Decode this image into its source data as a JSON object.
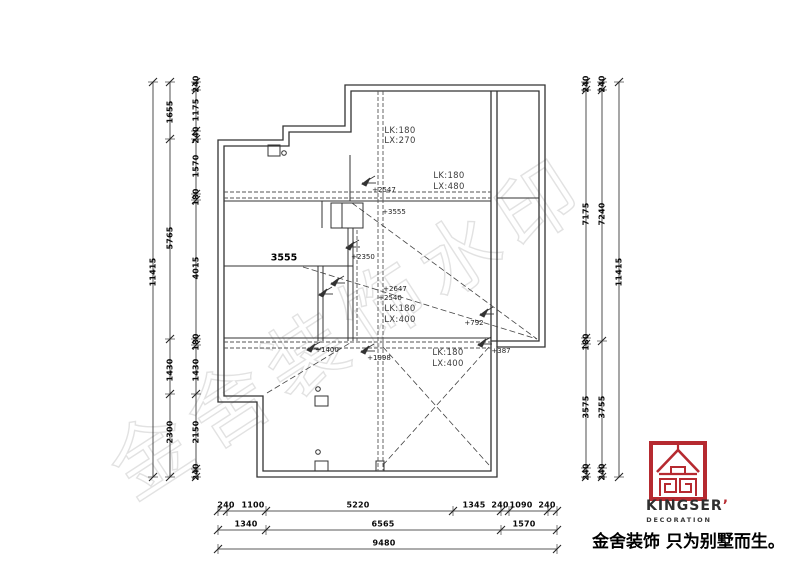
{
  "colors": {
    "accent_red": "#b62a30",
    "line": "#333333",
    "watermark_gray": "#e0e0e0"
  },
  "watermark": "金舍装饰水印",
  "logo": {
    "brand": "KINGSER",
    "mark": "’",
    "subtitle": "DECORATION",
    "tagline": "金舍装饰 只为别墅而生。"
  },
  "labels": [
    {
      "t": "240",
      "x": 196,
      "y": 84,
      "r": -90,
      "c": "dim"
    },
    {
      "t": "1175",
      "x": 196,
      "y": 110,
      "r": -90,
      "c": "dim"
    },
    {
      "t": "240",
      "x": 196,
      "y": 135,
      "r": -90,
      "c": "dim"
    },
    {
      "t": "1570",
      "x": 196,
      "y": 166,
      "r": -90,
      "c": "dim"
    },
    {
      "t": "180",
      "x": 196,
      "y": 197,
      "r": -90,
      "c": "dim"
    },
    {
      "t": "4015",
      "x": 196,
      "y": 268,
      "r": -90,
      "c": "dim"
    },
    {
      "t": "180",
      "x": 196,
      "y": 342,
      "r": -90,
      "c": "dim"
    },
    {
      "t": "1430",
      "x": 196,
      "y": 370,
      "r": -90,
      "c": "dim"
    },
    {
      "t": "2150",
      "x": 196,
      "y": 432,
      "r": -90,
      "c": "dim"
    },
    {
      "t": "240",
      "x": 196,
      "y": 472,
      "r": -90,
      "c": "dim"
    },
    {
      "t": "1655",
      "x": 170,
      "y": 112,
      "r": -90,
      "c": "dim"
    },
    {
      "t": "5765",
      "x": 170,
      "y": 238,
      "r": -90,
      "c": "dim"
    },
    {
      "t": "1430",
      "x": 170,
      "y": 370,
      "r": -90,
      "c": "dim"
    },
    {
      "t": "2300",
      "x": 170,
      "y": 432,
      "r": -90,
      "c": "dim"
    },
    {
      "t": "11415",
      "x": 153,
      "y": 272,
      "r": -90,
      "c": "dim"
    },
    {
      "t": "240",
      "x": 586,
      "y": 84,
      "r": -90,
      "c": "dim"
    },
    {
      "t": "7175",
      "x": 586,
      "y": 214,
      "r": -90,
      "c": "dim"
    },
    {
      "t": "180",
      "x": 586,
      "y": 342,
      "r": -90,
      "c": "dim"
    },
    {
      "t": "3575",
      "x": 586,
      "y": 407,
      "r": -90,
      "c": "dim"
    },
    {
      "t": "240",
      "x": 586,
      "y": 472,
      "r": -90,
      "c": "dim"
    },
    {
      "t": "240",
      "x": 602,
      "y": 84,
      "r": -90,
      "c": "dim"
    },
    {
      "t": "7240",
      "x": 602,
      "y": 214,
      "r": -90,
      "c": "dim"
    },
    {
      "t": "3755",
      "x": 602,
      "y": 407,
      "r": -90,
      "c": "dim"
    },
    {
      "t": "240",
      "x": 602,
      "y": 472,
      "r": -90,
      "c": "dim"
    },
    {
      "t": "11415",
      "x": 619,
      "y": 272,
      "r": -90,
      "c": "dim"
    },
    {
      "t": "240",
      "x": 226,
      "y": 505,
      "c": "dim"
    },
    {
      "t": "1100",
      "x": 253,
      "y": 505,
      "c": "dim"
    },
    {
      "t": "5220",
      "x": 358,
      "y": 505,
      "c": "dim"
    },
    {
      "t": "1345",
      "x": 474,
      "y": 505,
      "c": "dim"
    },
    {
      "t": "240",
      "x": 500,
      "y": 505,
      "c": "dim"
    },
    {
      "t": "1090",
      "x": 521,
      "y": 505,
      "c": "dim"
    },
    {
      "t": "240",
      "x": 547,
      "y": 505,
      "c": "dim"
    },
    {
      "t": "1340",
      "x": 246,
      "y": 524,
      "c": "dim"
    },
    {
      "t": "6565",
      "x": 383,
      "y": 524,
      "c": "dim"
    },
    {
      "t": "1570",
      "x": 524,
      "y": 524,
      "c": "dim"
    },
    {
      "t": "9480",
      "x": 384,
      "y": 543,
      "c": "dim"
    },
    {
      "n": "room-dim-label",
      "t": "3555",
      "x": 284,
      "y": 258,
      "c": "dimb"
    },
    {
      "n": "level-label",
      "t": "+2547",
      "x": 384,
      "y": 190,
      "c": "lvl"
    },
    {
      "n": "level-label",
      "t": "+3555",
      "x": 394,
      "y": 212,
      "c": "lvl"
    },
    {
      "n": "level-label",
      "t": "+2350",
      "x": 363,
      "y": 257,
      "c": "lvl"
    },
    {
      "n": "level-label",
      "t": "+2647",
      "x": 395,
      "y": 289,
      "c": "lvl"
    },
    {
      "n": "level-label",
      "t": "+2540",
      "x": 390,
      "y": 298,
      "c": "lvl"
    },
    {
      "n": "level-label",
      "t": "+792",
      "x": 474,
      "y": 323,
      "c": "lvl"
    },
    {
      "n": "level-label",
      "t": "+387",
      "x": 501,
      "y": 351,
      "c": "lvl"
    },
    {
      "n": "level-label",
      "t": "+1400",
      "x": 327,
      "y": 350,
      "c": "lvl"
    },
    {
      "n": "level-label",
      "t": "+1998",
      "x": 379,
      "y": 358,
      "c": "lvl"
    },
    {
      "n": "beam-label",
      "t": "LK:180",
      "x": 400,
      "y": 131,
      "c": "lk"
    },
    {
      "n": "beam-label",
      "t": "LX:270",
      "x": 400,
      "y": 141,
      "c": "lk"
    },
    {
      "n": "beam-label",
      "t": "LK:180",
      "x": 449,
      "y": 176,
      "c": "lk"
    },
    {
      "n": "beam-label",
      "t": "LX:480",
      "x": 449,
      "y": 187,
      "c": "lk"
    },
    {
      "n": "beam-label",
      "t": "LK:180",
      "x": 400,
      "y": 309,
      "c": "lk"
    },
    {
      "n": "beam-label",
      "t": "LX:400",
      "x": 400,
      "y": 320,
      "c": "lk"
    },
    {
      "n": "beam-label",
      "t": "LK:180",
      "x": 448,
      "y": 353,
      "c": "lk"
    },
    {
      "n": "beam-label",
      "t": "LX:400",
      "x": 448,
      "y": 364,
      "c": "lk"
    }
  ]
}
